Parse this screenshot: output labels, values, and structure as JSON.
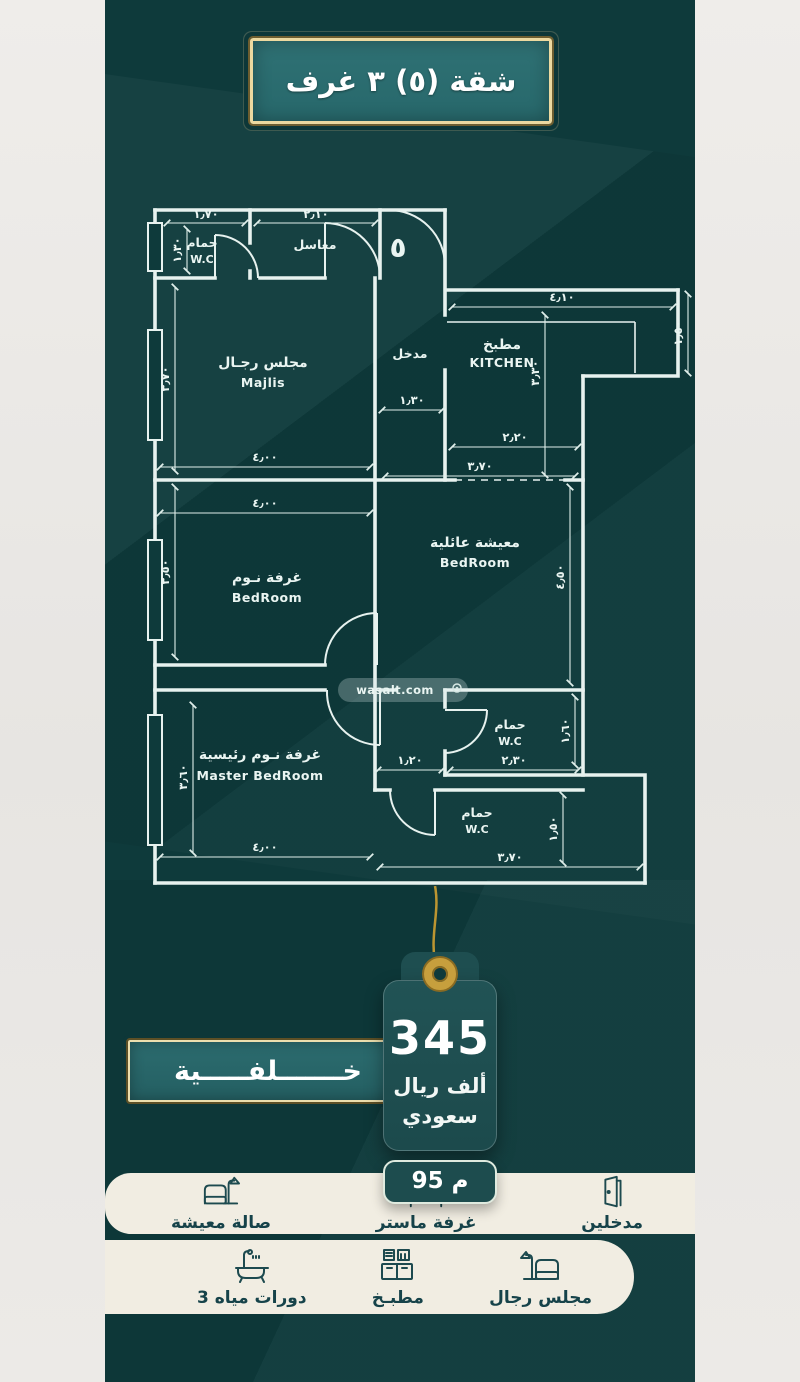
{
  "title": "شقة (٥)  ٣ غرف",
  "unit_number": "٥",
  "watermark": "wasalt.com",
  "plan": {
    "labels": {
      "bath_top": {
        "ar": "حمام",
        "en": "W.C"
      },
      "sinks": {
        "ar": "مغاسل"
      },
      "majlis": {
        "ar": "مجلس رجـال",
        "en": "Majlis"
      },
      "entry": {
        "ar": "مدخل"
      },
      "kitchen": {
        "ar": "مطبخ",
        "en": "KITCHEN"
      },
      "family": {
        "ar": "معيشة عائلية",
        "en": "BedRoom"
      },
      "bedroom": {
        "ar": "غرفة نـوم",
        "en": "BedRoom"
      },
      "master": {
        "ar": "غرفة نـوم رئيسية",
        "en": "Master BedRoom"
      },
      "wc_mid": {
        "ar": "حمام",
        "en": "W.C"
      },
      "wc_bottom": {
        "ar": "حمام",
        "en": "W.C"
      }
    },
    "dims": {
      "bath_w": "١٫٧٠",
      "bath_h": "١٫٣٠",
      "sinks_w": "٢٫١٠",
      "majlis_h": "٣٫٧٠",
      "majlis_w": "٤٫٠٠",
      "entry_w": "١٫٣٠",
      "kitchen_w": "٤٫١٠",
      "kitchen_side": "١٫٥٠",
      "kitchen_h": "٣٫٣٠",
      "kitchen_b": "٢٫٢٠",
      "bedroom_w": "٤٫٠٠",
      "bedroom_h": "٣٫٥٠",
      "family_w": "٣٫٧٠",
      "family_h": "٤٫٥٠",
      "master_w": "٤٫٠٠",
      "master_h": "٣٫٦٠",
      "hall_w": "١٫٢٠",
      "wc_mid_w": "٢٫٣٠",
      "wc_mid_h": "١٫٦٠",
      "wc_bot_w": "٣٫٧٠",
      "wc_bot_h": "١٫٥٠"
    }
  },
  "price_tag": {
    "value": "345",
    "unit_line1": "ألف ريال",
    "unit_line2": "سعودي",
    "area": "95 م"
  },
  "rear_banner": "خـــــــلفـــــية",
  "amenities": {
    "row1": [
      {
        "label": "مدخلين",
        "icon": "door"
      },
      {
        "label": "غرفة ماستر",
        "icon": "bed"
      },
      {
        "label": "صالة معيشة",
        "icon": "sofa-lamp"
      }
    ],
    "row2": [
      {
        "label": "مجلس رجال",
        "icon": "sofa-lamp"
      },
      {
        "label": "مطبـخ",
        "icon": "kitchen"
      },
      {
        "label": "3 دورات مياه",
        "icon": "bathtub"
      }
    ]
  },
  "colors": {
    "teal_bg": "#0e3a3b",
    "banner_fill": "#2e6e71",
    "gold": "#c79f3d",
    "plan_line": "#e7f2ef",
    "cream": "#f1ede2",
    "tag_fill": "#1d4c4e"
  }
}
